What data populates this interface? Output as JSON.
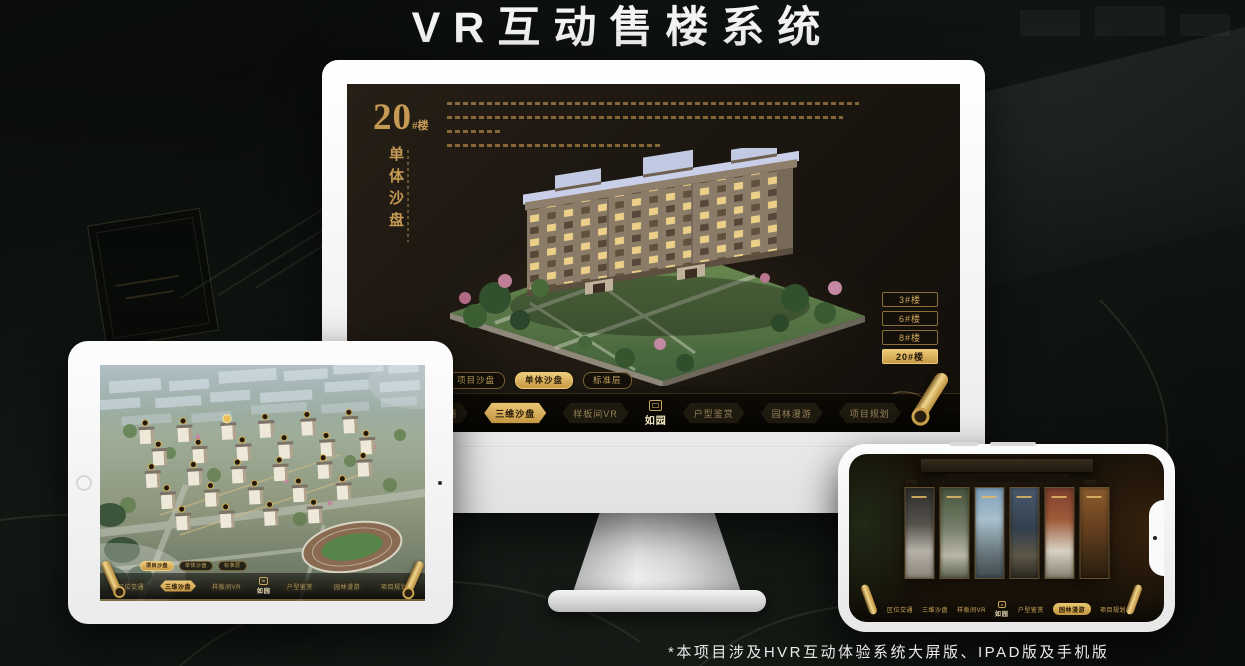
{
  "page": {
    "title": "VR互动售楼系统",
    "footnote": "*本项目涉及HVR互动体验系统大屏版、IPAD版及手机版"
  },
  "colors": {
    "gold": "#c9a05f",
    "gold_bright": "#e4c06a",
    "screen_dark": "#1b1610",
    "page_background": "#070907",
    "title_white": "#f4f4f4"
  },
  "icons": {
    "scroll_icon": "rolled gold scroll decoration",
    "seal_icon": "square seal mark above logo text",
    "home_button": "tablet circular home button",
    "camera_icon": "front camera dot",
    "notch": "phone landscape notch pill"
  },
  "monitor": {
    "building_label": {
      "number": "20",
      "suffix": "#楼",
      "vertical_title": "单体沙盘"
    },
    "floor_buttons": [
      {
        "label": "3#楼",
        "active": false
      },
      {
        "label": "6#楼",
        "active": false
      },
      {
        "label": "8#楼",
        "active": false
      },
      {
        "label": "20#楼",
        "active": true
      }
    ],
    "sub_tabs": [
      {
        "label": "项目沙盘",
        "active": false
      },
      {
        "label": "单体沙盘",
        "active": true
      },
      {
        "label": "标准层",
        "active": false
      }
    ],
    "nav": {
      "left": [
        {
          "label": "区位交通",
          "active": false
        },
        {
          "label": "三维沙盘",
          "active": true
        },
        {
          "label": "样板间VR",
          "active": false
        }
      ],
      "logo": "如园",
      "right": [
        {
          "label": "户型鉴赏",
          "active": false
        },
        {
          "label": "园林漫游",
          "active": false
        },
        {
          "label": "项目规划",
          "active": false
        }
      ]
    }
  },
  "tablet": {
    "sub_tabs": [
      {
        "label": "项目沙盘",
        "active": true
      },
      {
        "label": "单体沙盘",
        "active": false
      },
      {
        "label": "标准层",
        "active": false
      }
    ],
    "nav": {
      "left": [
        {
          "label": "区位交通",
          "active": false
        },
        {
          "label": "三维沙盘",
          "active": true
        },
        {
          "label": "样板间VR",
          "active": false
        }
      ],
      "logo": "如园",
      "right": [
        {
          "label": "户型鉴赏",
          "active": false
        },
        {
          "label": "园林漫游",
          "active": false
        },
        {
          "label": "项目规划",
          "active": false
        }
      ]
    }
  },
  "phone": {
    "nav": {
      "left": [
        {
          "label": "区位交通",
          "active": false
        },
        {
          "label": "三维沙盘",
          "active": false
        },
        {
          "label": "样板间VR",
          "active": false
        }
      ],
      "logo": "如园",
      "right": [
        {
          "label": "户型鉴赏",
          "active": false
        },
        {
          "label": "园林漫游",
          "active": true
        },
        {
          "label": "项目规划",
          "active": false
        }
      ]
    }
  }
}
